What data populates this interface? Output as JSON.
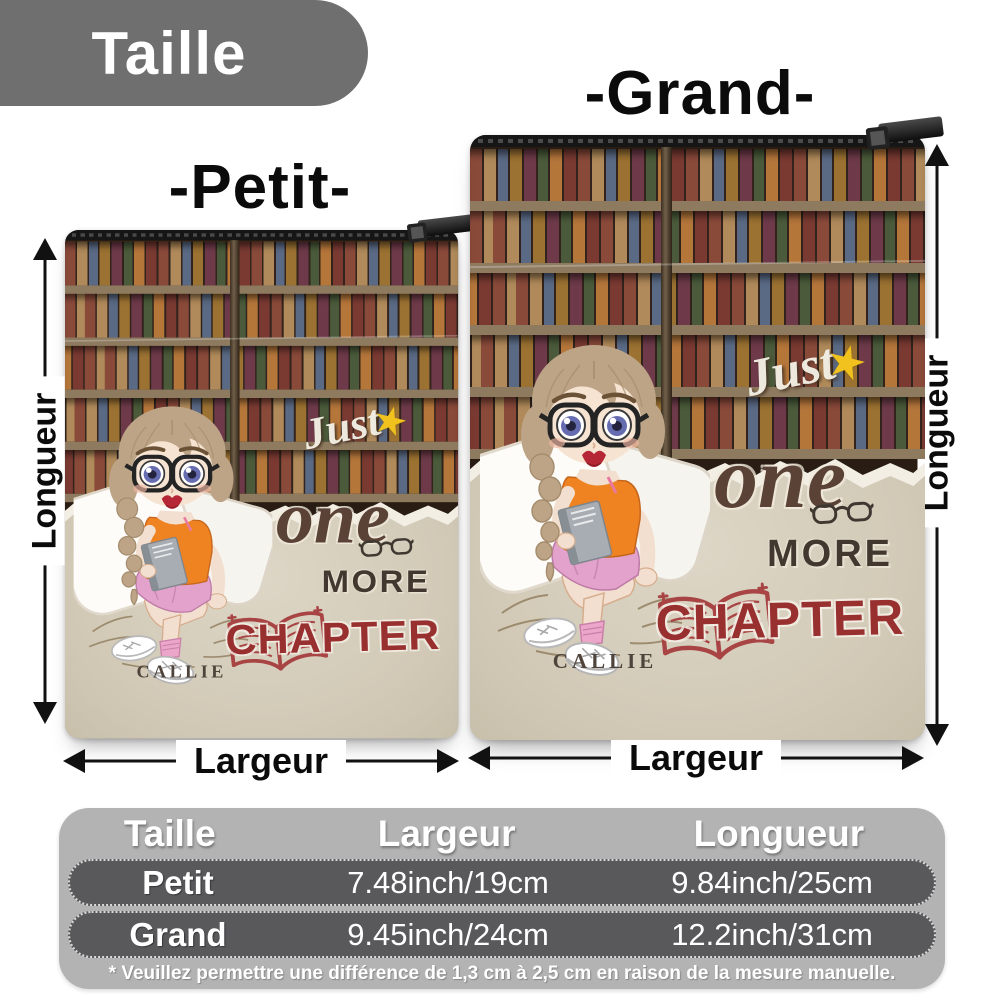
{
  "page": {
    "title": "Taille"
  },
  "size_labels": {
    "petit": "-Petit-",
    "grand": "-Grand-"
  },
  "dimensions": {
    "largeur": "Largeur",
    "longueur": "Longueur"
  },
  "design": {
    "word_just": "Just",
    "word_one": "one",
    "word_more": "MORE",
    "word_chapter": "CHAPTER",
    "name": "CALLIE",
    "star_glyph": "★",
    "star_icon": "star-icon",
    "book_icon": "open-book-icon",
    "glasses_icon": "glasses-icon"
  },
  "table": {
    "headers": [
      "Taille",
      "Largeur",
      "Longueur"
    ],
    "rows": [
      [
        "Petit",
        "7.48inch/19cm",
        "9.84inch/25cm"
      ],
      [
        "Grand",
        "9.45inch/24cm",
        "12.2inch/31cm"
      ]
    ],
    "footnote": "* Veuillez permettre une différence de 1,3 cm à 2,5 cm en raison de la mesure manuelle."
  },
  "colors": {
    "ribbon_gray": "#6f6f6f",
    "table_bg": "#b3b3b3",
    "row_bg": "#59595c",
    "chapter_red": "#993030",
    "script_brown": "#5a4236",
    "star_yellow": "#f1c11d",
    "paper_beige": "#d3cbb8",
    "arrow_black": "#111111"
  }
}
